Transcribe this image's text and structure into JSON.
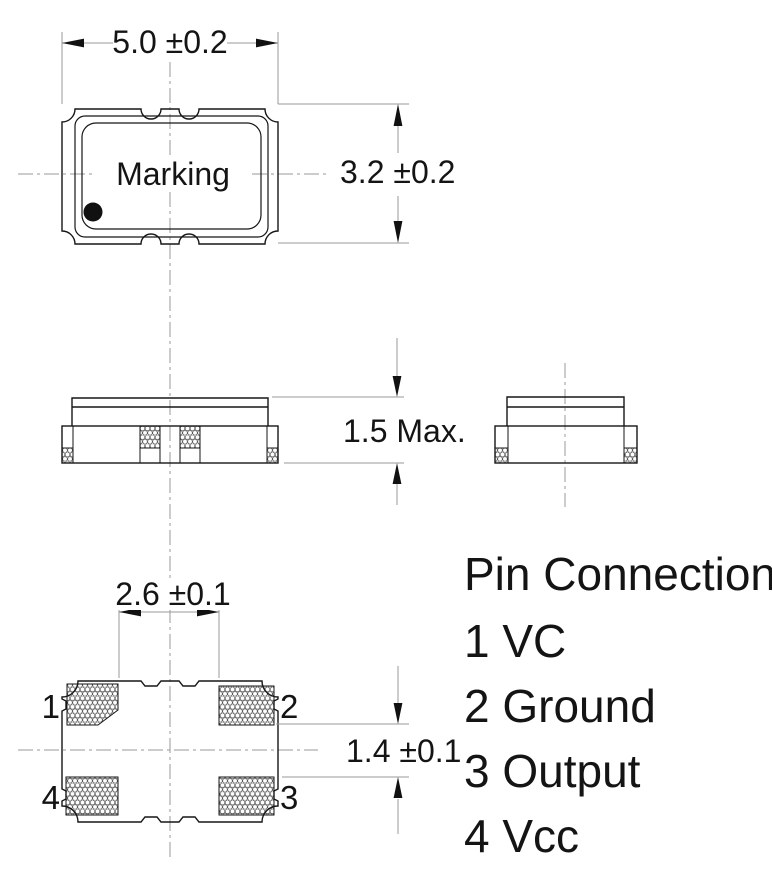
{
  "top_view": {
    "marking": "Marking",
    "dim_width": "5.0 ±0.2",
    "dim_height": "3.2 ±0.2"
  },
  "side_view": {
    "dim_height": "1.5 Max."
  },
  "bottom_view": {
    "dim_pad_span": "2.6 ±0.1",
    "dim_pad_gap": "1.4 ±0.1",
    "pins": {
      "pin1": "1",
      "pin2": "2",
      "pin3": "3",
      "pin4": "4"
    }
  },
  "pin_connection": {
    "title": "Pin Connection",
    "items": [
      "1 VC",
      "2 Ground",
      "3 Output",
      "4 Vcc"
    ]
  }
}
